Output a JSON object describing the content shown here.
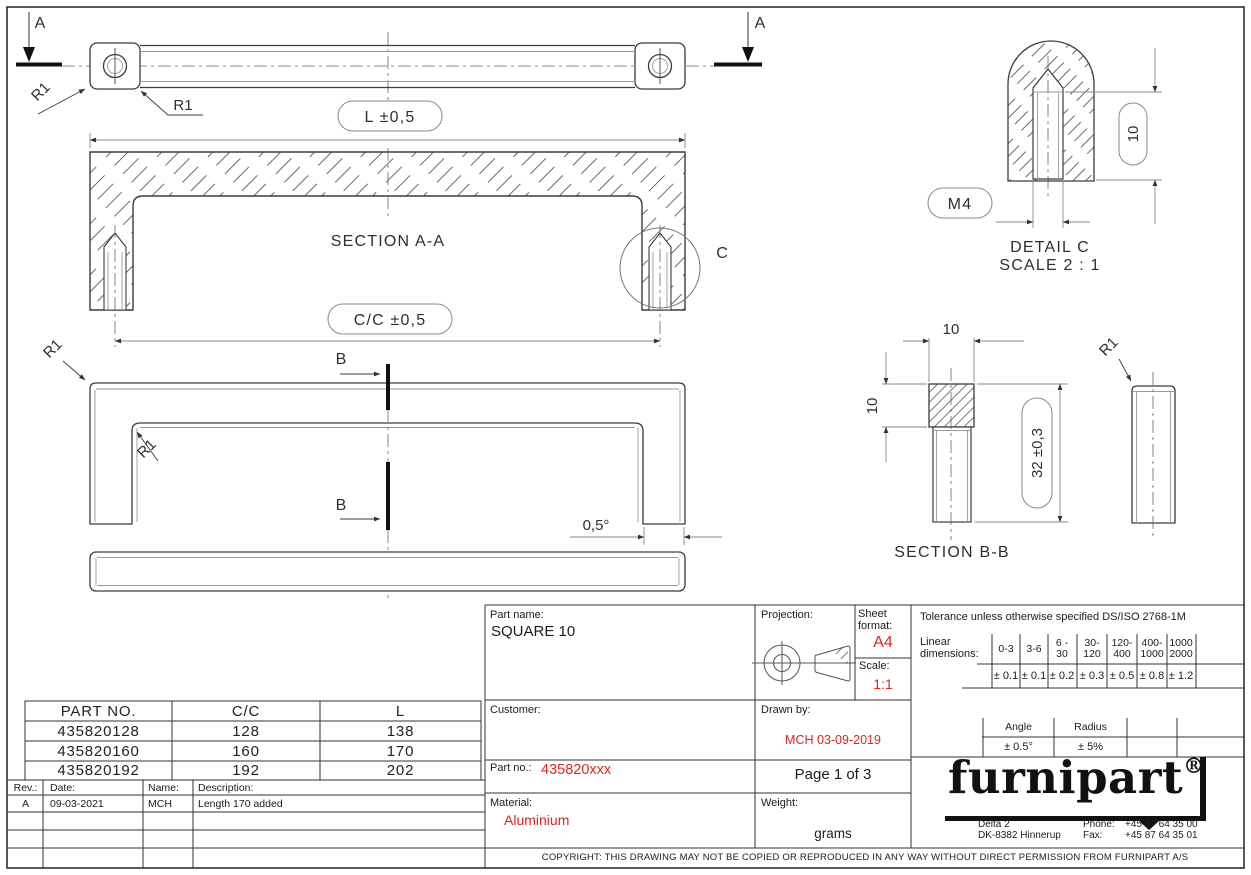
{
  "colors": {
    "accent_red": "#e02420",
    "line_dark": "#3c3c3c",
    "line_dim": "#8a8a8a"
  },
  "drawing": {
    "view_letters": {
      "a": "A",
      "b": "B",
      "c": "C"
    },
    "fillet_label": "R1",
    "dims": {
      "length": "L ±0,5",
      "cc": "C/C ±0,5",
      "draft_angle": "0,5°",
      "square": "10",
      "thread": "M4",
      "height": "32 ±0,3"
    },
    "captions": {
      "section_aa": "SECTION A-A",
      "section_bb": "SECTION B-B",
      "detail_c": "DETAIL C",
      "detail_c_scale": "SCALE 2 : 1"
    }
  },
  "part_table": {
    "headers": [
      "PART NO.",
      "C/C",
      "L"
    ],
    "rows": [
      [
        "435820128",
        "128",
        "138"
      ],
      [
        "435820160",
        "160",
        "170"
      ],
      [
        "435820192",
        "192",
        "202"
      ]
    ]
  },
  "rev_table": {
    "headers": [
      "Rev.:",
      "Date:",
      "Name:",
      "Description:"
    ],
    "rows": [
      [
        "A",
        "09-03-2021",
        "MCH",
        "Length 170 added"
      ]
    ]
  },
  "title_block": {
    "part_name_label": "Part name:",
    "part_name": "SQUARE 10",
    "customer_label": "Customer:",
    "projection_label": "Projection:",
    "sheet_format_label": "Sheet format:",
    "sheet_format": "A4",
    "scale_label": "Scale:",
    "scale": "1:1",
    "drawn_by_label": "Drawn by:",
    "drawn_by": "MCH 03-09-2019",
    "part_no_label": "Part no.:",
    "part_no": "435820xxx",
    "page_info": "Page 1 of 3",
    "material_label": "Material:",
    "material": "Aluminium",
    "weight_label": "Weight:",
    "weight_unit": "grams"
  },
  "tolerance_block": {
    "title": "Tolerance unless otherwise specified DS/ISO 2768-1M",
    "linear_label": "Linear\ndimensions:",
    "ranges": [
      "0-3",
      "3-6",
      "6 -\n30",
      "30-\n120",
      "120-\n400",
      "400-\n1000",
      "1000\n2000"
    ],
    "values": [
      "± 0.1",
      "± 0.1",
      "± 0.2",
      "± 0.3",
      "± 0.5",
      "± 0.8",
      "± 1.2"
    ],
    "angle_label": "Angle",
    "angle_value": "± 0.5°",
    "radius_label": "Radius",
    "radius_value": "± 5%"
  },
  "logo": {
    "name": "furnipart",
    "registered": "®",
    "address_line1": "Delta 2",
    "address_line2": "DK-8382 Hinnerup",
    "phone_label": "Phone:",
    "phone_value": "+45 87 64 35 00",
    "fax_label": "Fax:",
    "fax_value": "+45 87 64 35 01"
  },
  "copyright": "COPYRIGHT: THIS DRAWING MAY NOT BE COPIED OR REPRODUCED IN ANY WAY WITHOUT DIRECT PERMISSION FROM FURNIPART A/S"
}
